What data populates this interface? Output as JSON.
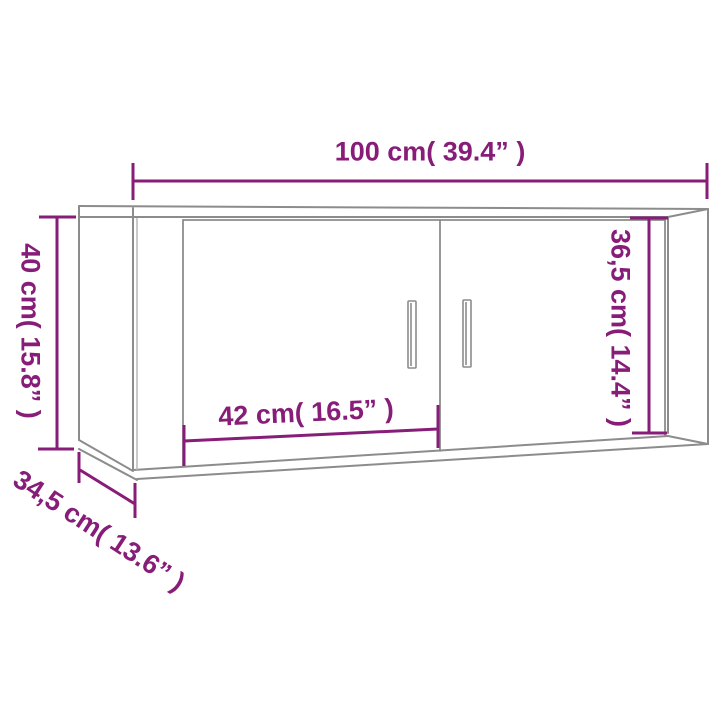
{
  "diagram": {
    "subject": "wall-mounted-tv-cabinet",
    "labels": {
      "width": "100 cm( 39.4” )",
      "height": "40 cm( 15.8” )",
      "inner_height": "36,5 cm( 14.4” )",
      "door_width": "42 cm( 16.5” )",
      "depth": "34,5 cm( 13.6” )"
    },
    "values": {
      "width_cm": 100,
      "width_in": 39.4,
      "height_cm": 40,
      "height_in": 15.8,
      "inner_height_cm": 36.5,
      "inner_height_in": 14.4,
      "door_width_cm": 42,
      "door_width_in": 16.5,
      "depth_cm": 34.5,
      "depth_in": 13.6
    },
    "colors": {
      "dimension_accent": "#871d78",
      "outline": "#8c8c8c",
      "outline_light": "#b3b3b3"
    }
  }
}
